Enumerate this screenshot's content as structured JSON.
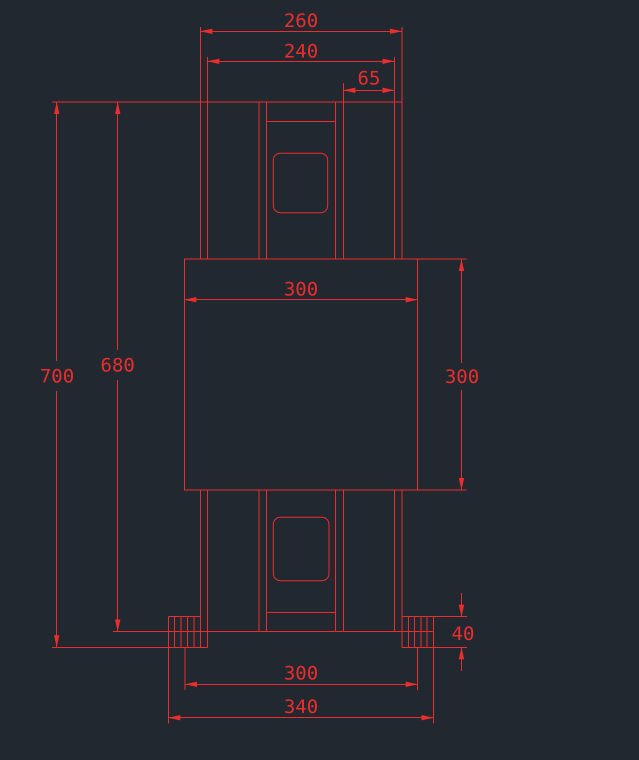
{
  "app": {
    "view": "cad-drawing-canvas"
  },
  "colors": {
    "background": "#212830",
    "line": "#ec2d2d"
  },
  "canvas": {
    "width": 639,
    "height": 760
  },
  "dims": {
    "top_outer": "260",
    "top_inner": "240",
    "top_offset": "65",
    "overall_height": "700",
    "body_height": "680",
    "block_width": "300",
    "block_height": "300",
    "base_inner": "300",
    "base_outer": "340",
    "foot_height": "40"
  }
}
